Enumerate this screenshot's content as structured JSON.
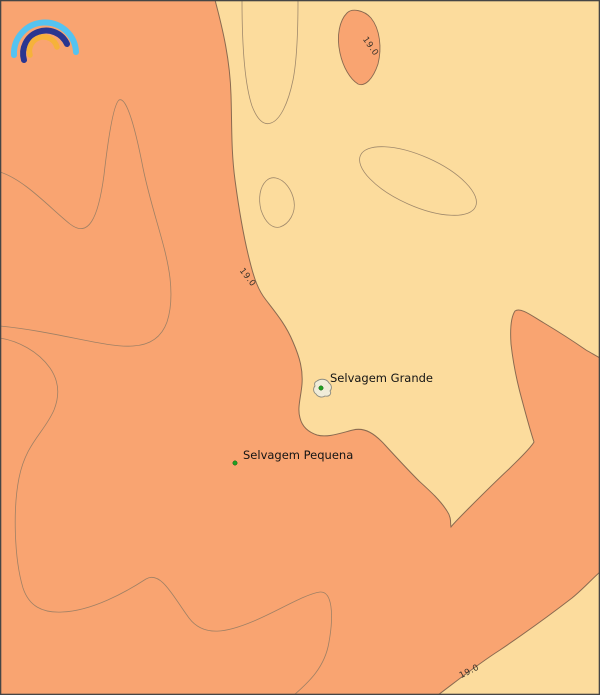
{
  "colors": {
    "sea-warm": "#f9a471",
    "sea-cool": "#fcdc9d",
    "contour-line": "#8f7a63",
    "contour-strong": "#8a6a50",
    "contour-label": "#3a332a",
    "island-fill": "#f0ecd9",
    "island-outline": "#8b8b80",
    "marker": "#21a121",
    "marker-edge": "#145c14",
    "label": "#141414",
    "frame": "#454545",
    "logo-outer": "#55c3f0",
    "logo-middle": "#2a3690",
    "logo-inner": "#f6b23a"
  },
  "map": {
    "places": [
      {
        "label": "Selvagem Grande"
      },
      {
        "label": "Selvagem Pequena"
      }
    ],
    "isotherms": [
      {
        "label": "19.0"
      },
      {
        "label": "19.0"
      },
      {
        "label": "19.0"
      }
    ]
  }
}
